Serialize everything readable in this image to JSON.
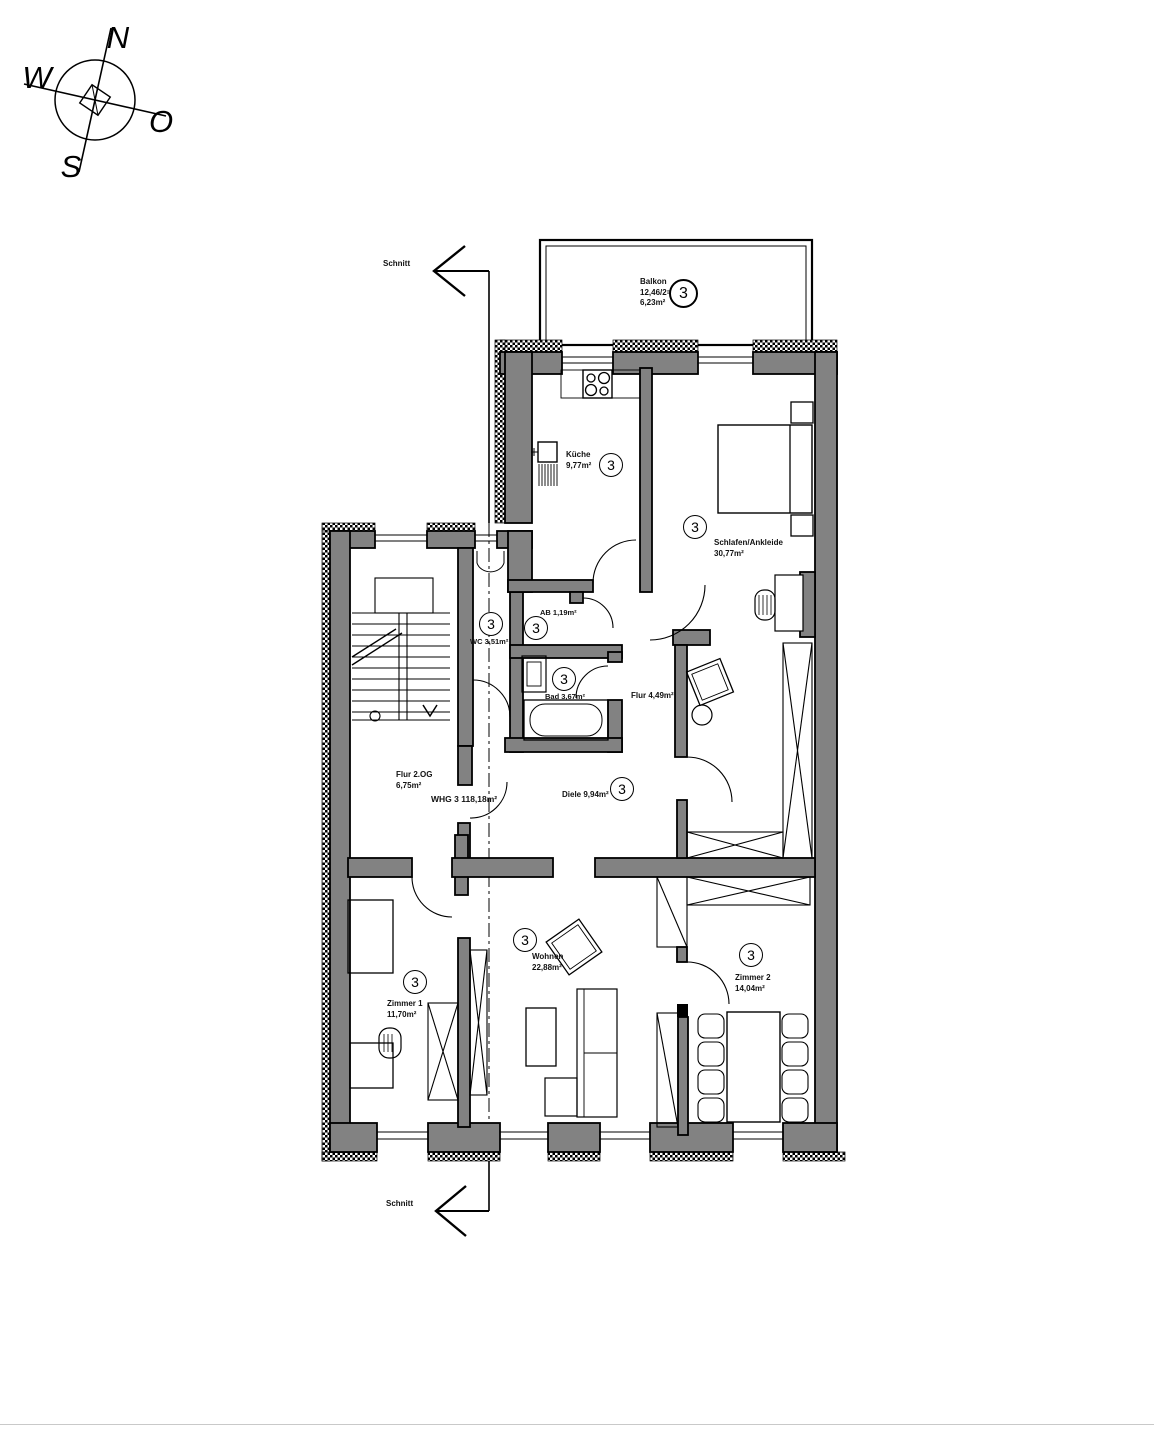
{
  "compass": {
    "north": "N",
    "west": "W",
    "east": "O",
    "south": "S"
  },
  "section_marks": {
    "top": "Schnitt",
    "bottom": "Schnitt"
  },
  "unit": {
    "label": "WHG 3 118,18m²"
  },
  "rooms": {
    "balkon": {
      "name": "Balkon",
      "area_calc": "12,46/2=",
      "area": "6,23m²",
      "number": "3"
    },
    "kueche": {
      "name": "Küche",
      "area": "9,77m²",
      "number": "3"
    },
    "schlafen": {
      "name": "Schlafen/Ankleide",
      "area": "30,77m²",
      "number": "3"
    },
    "wc": {
      "label": "WC 3,51m²",
      "number": "3"
    },
    "ab": {
      "label": "AB 1,19m²",
      "number": "3"
    },
    "bad": {
      "label": "Bad 3,67m²",
      "number": "3"
    },
    "flur": {
      "label": "Flur 4,49m²"
    },
    "flur_og": {
      "name": "Flur 2.OG",
      "area": "6,75m²"
    },
    "diele": {
      "label": "Diele 9,94m²",
      "number": "3"
    },
    "wohnen": {
      "name": "Wohnen",
      "area": "22,88m²",
      "number": "3"
    },
    "zimmer1": {
      "name": "Zimmer 1",
      "area": "11,70m²",
      "number": "3"
    },
    "zimmer2": {
      "name": "Zimmer 2",
      "area": "14,04m²",
      "number": "3"
    }
  },
  "colors": {
    "wall": "#828282",
    "line": "#000000",
    "background": "#ffffff"
  }
}
